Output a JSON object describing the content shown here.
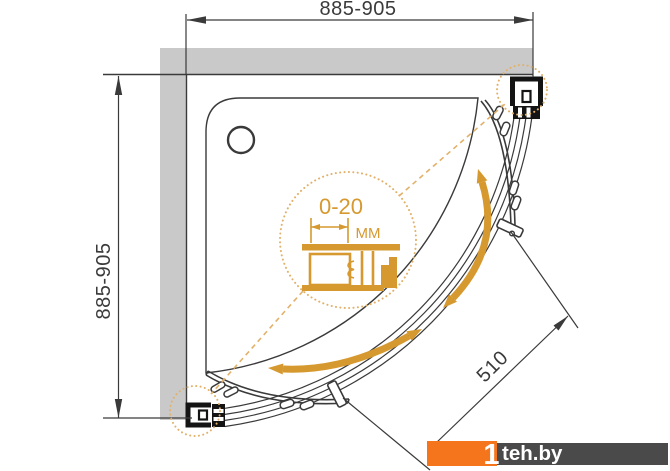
{
  "figure": {
    "type": "technical-drawing",
    "subject": "quarter-round corner shower enclosure, top view"
  },
  "dimensions": {
    "top_width": "885-905",
    "left_depth": "885-905",
    "door_opening": "510"
  },
  "detail_callout": {
    "adjustment_range": "0-20",
    "unit": "ММ"
  },
  "watermark": {
    "prefix": "1",
    "site": "teh.by"
  },
  "icons": {
    "drain": "drain-circle",
    "slide_arrow_right": "door-slide-arrow",
    "slide_arrow_bottom": "door-slide-arrow"
  },
  "colors": {
    "line": "#3a3a3a",
    "profile": "#141414",
    "wall": "#c9c9c9",
    "accent": "#d6992f",
    "accent_light": "#e2b169",
    "watermark_orange": "#f4751c",
    "watermark_gray": "#4a4a4a"
  }
}
